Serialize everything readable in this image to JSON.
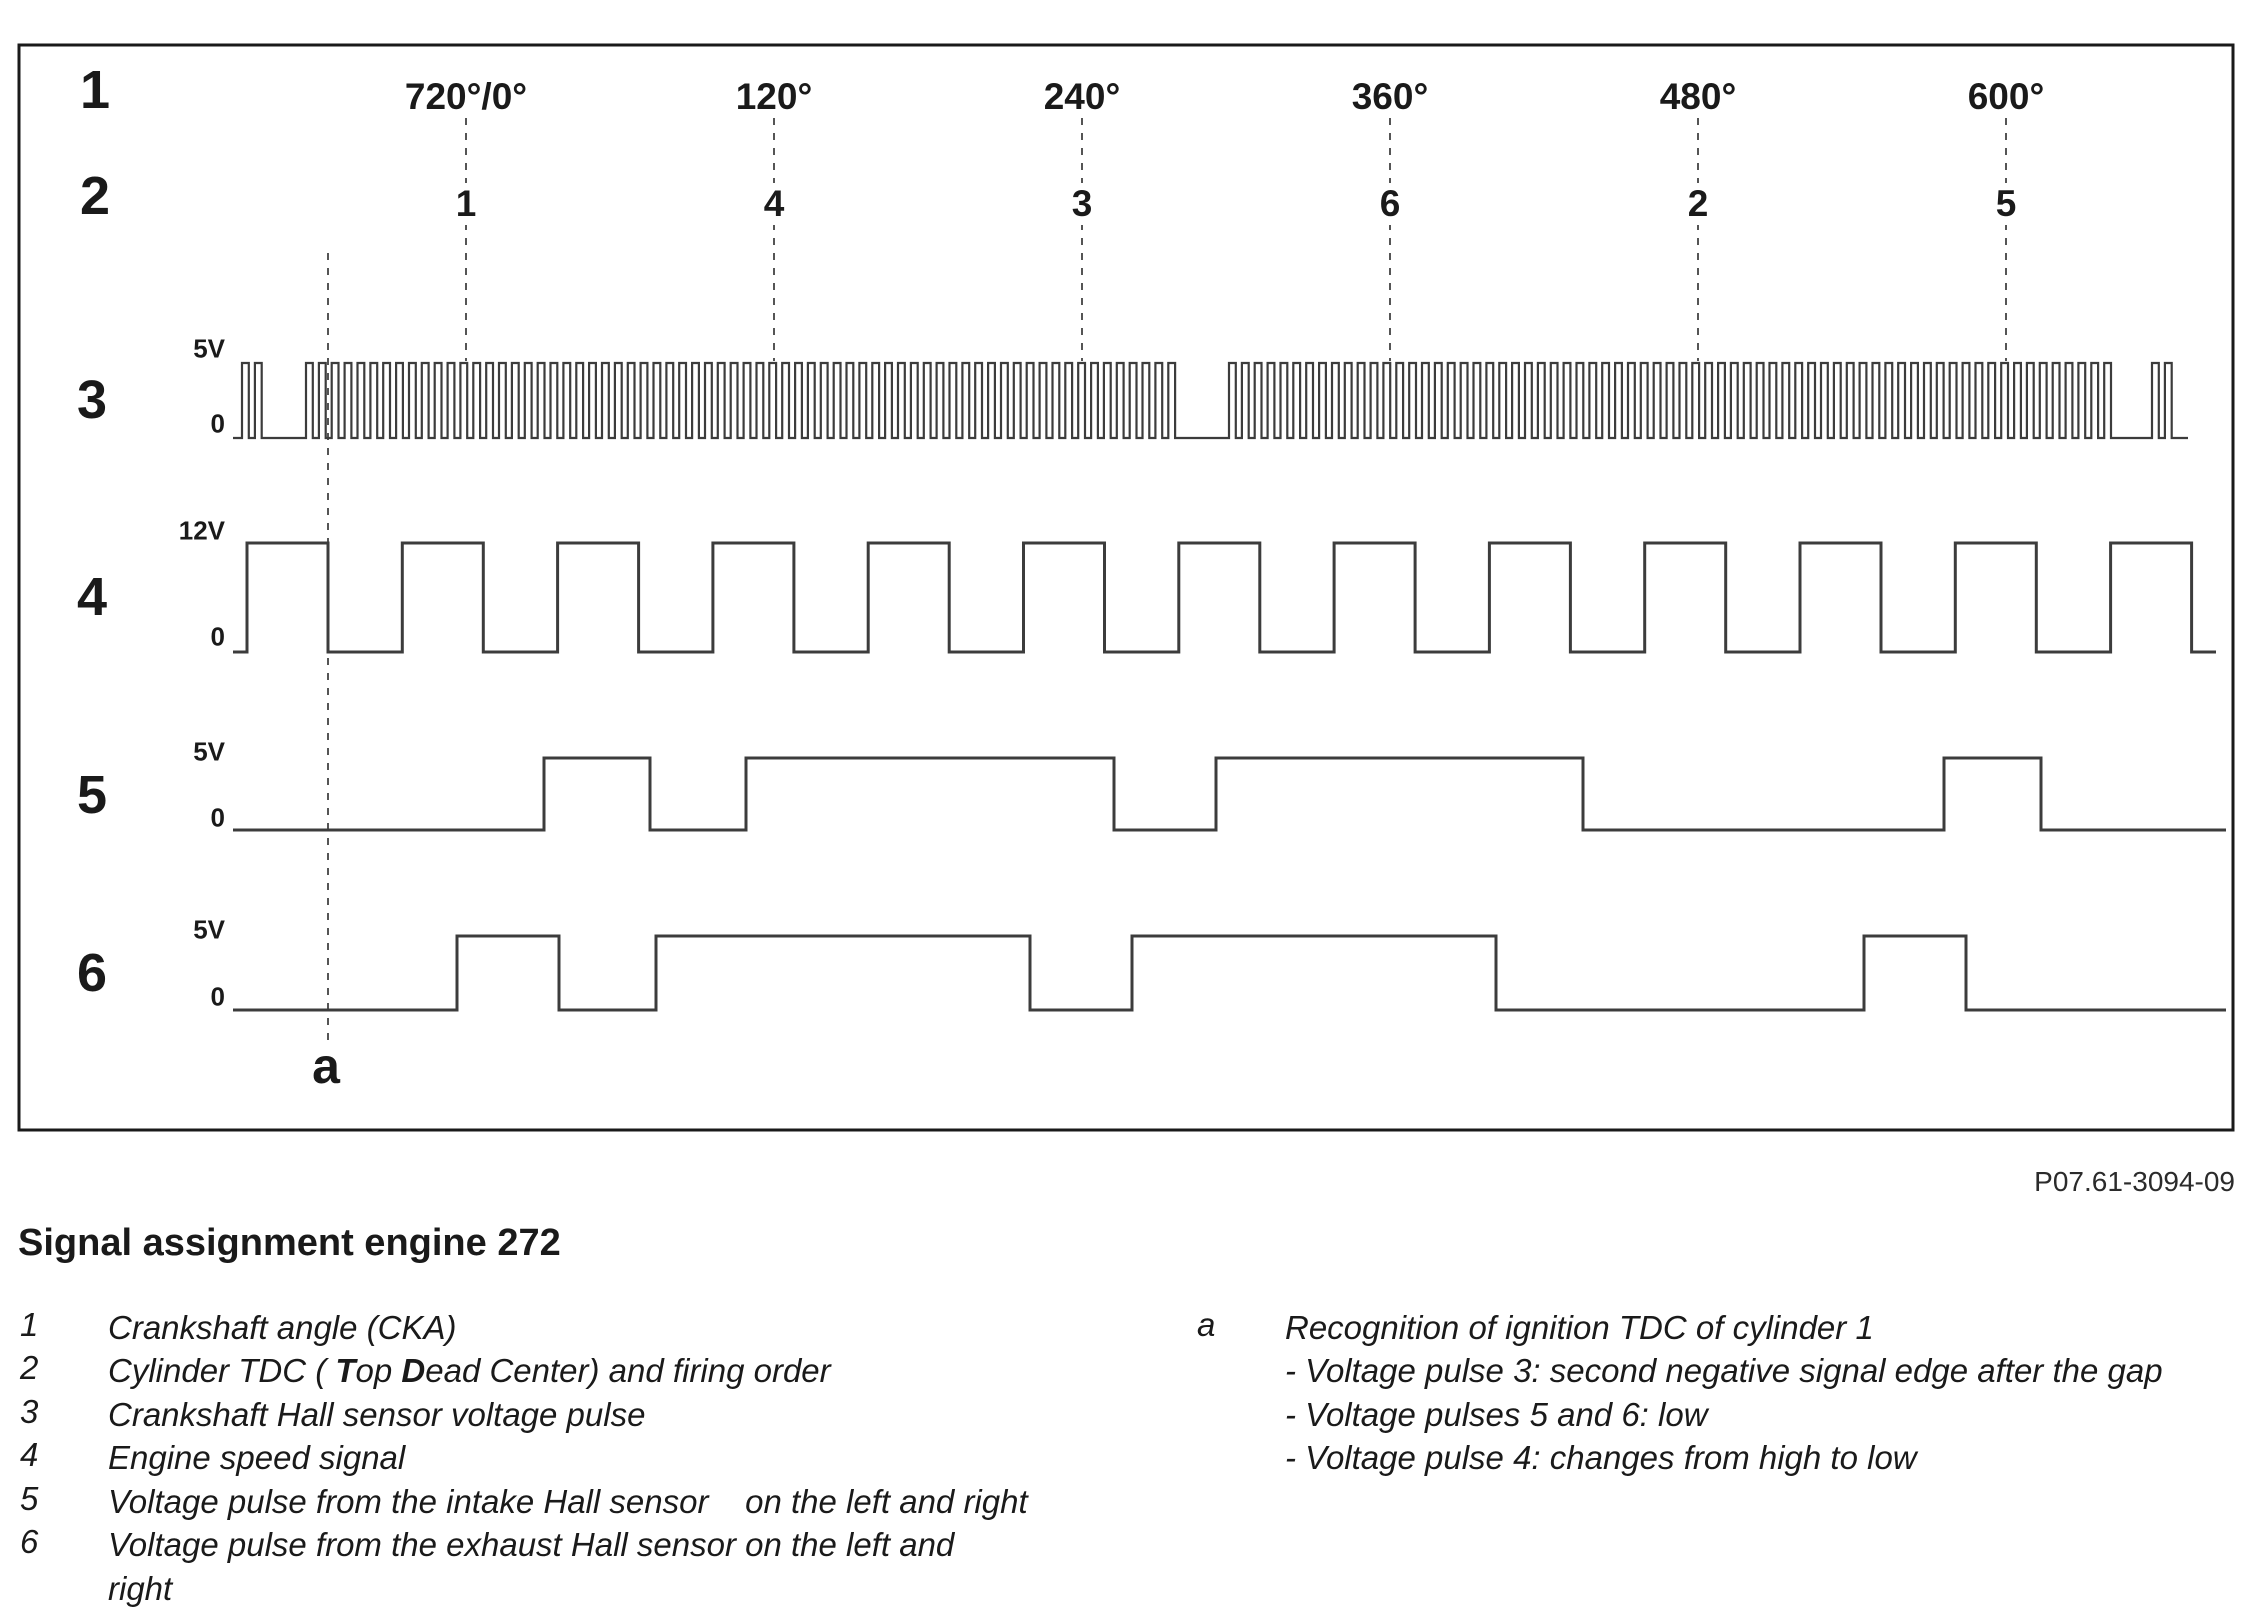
{
  "figure_code": "P07.61-3094-09",
  "title": "Signal assignment engine 272",
  "colors": {
    "background": "#ffffff",
    "text": "#1a1a1a",
    "waveform": "#3c3c3c",
    "dashed_line": "#555555",
    "border": "#1a1a1a"
  },
  "diagram": {
    "row_labels": [
      "1",
      "2",
      "3",
      "4",
      "5",
      "6"
    ],
    "degree_labels": [
      "720°/0°",
      "120°",
      "240°",
      "360°",
      "480°",
      "600°"
    ],
    "firing_order": [
      "1",
      "4",
      "3",
      "6",
      "2",
      "5"
    ],
    "marker_label": "a",
    "signal_rows": [
      {
        "id": "3",
        "high_label": "5V",
        "low_label": "0"
      },
      {
        "id": "4",
        "high_label": "12V",
        "low_label": "0"
      },
      {
        "id": "5",
        "high_label": "5V",
        "low_label": "0"
      },
      {
        "id": "6",
        "high_label": "5V",
        "low_label": "0"
      }
    ]
  },
  "waveforms": {
    "box": {
      "x": 19,
      "y": 45,
      "w": 2214,
      "h": 1085
    },
    "degree_lines": {
      "x": [
        466,
        774,
        1082,
        1390,
        1698,
        2006
      ],
      "y1": 118,
      "y2": 361
    },
    "marker_line": {
      "x": 328,
      "y1": 253,
      "y2": 1045
    },
    "rows": [
      {
        "name": "crankshaft-hall-waveform",
        "y_high": 363,
        "y_low": 438,
        "x_start": 233,
        "x_end": 2188,
        "stroke": 2.2,
        "pitch": 12.87,
        "high_width": 6.8,
        "pulse_groups": [
          {
            "start": 242,
            "count": 2
          },
          {
            "start": 306,
            "count": 68
          },
          {
            "start": 1229,
            "count": 69
          },
          {
            "start": 2152,
            "count": 2
          }
        ]
      },
      {
        "name": "engine-speed-waveform",
        "y_high": 543,
        "y_low": 652,
        "x_start": 233,
        "x_end": 2216,
        "stroke": 3,
        "periodic": {
          "first_rise": 247,
          "period": 155.3,
          "high_width": 81,
          "count": 13
        }
      },
      {
        "name": "intake-hall-waveform",
        "y_high": 758,
        "y_low": 830,
        "x_start": 233,
        "x_end": 2226,
        "stroke": 3,
        "pairs": [
          [
            544,
            650
          ],
          [
            746,
            1114
          ],
          [
            1216,
            1583
          ],
          [
            1944,
            2041
          ]
        ]
      },
      {
        "name": "exhaust-hall-waveform",
        "y_high": 936,
        "y_low": 1010,
        "x_start": 233,
        "x_end": 2226,
        "stroke": 3,
        "pairs": [
          [
            457,
            559
          ],
          [
            656,
            1030
          ],
          [
            1132,
            1496
          ],
          [
            1864,
            1966
          ]
        ]
      }
    ]
  },
  "legend": {
    "left": [
      {
        "num": "1",
        "text": "Crankshaft angle (CKA)"
      },
      {
        "num": "2",
        "parts": [
          "Cylinder TDC ( ",
          "T",
          "op ",
          "D",
          "ead Center) and firing order"
        ]
      },
      {
        "num": "3",
        "text": "Crankshaft Hall sensor voltage pulse"
      },
      {
        "num": "4",
        "text": "Engine speed signal"
      },
      {
        "num": "5",
        "text": "Voltage pulse from the intake Hall sensor    on the left and right"
      },
      {
        "num": "6",
        "text": "Voltage pulse from the exhaust Hall sensor on the left and\nright"
      }
    ],
    "right": {
      "num": "a",
      "text": "Recognition of ignition TDC of cylinder 1",
      "sub": [
        "- Voltage pulse 3: second negative signal edge after the gap",
        "- Voltage pulses 5 and 6: low",
        "- Voltage pulse 4: changes from high to low"
      ]
    }
  }
}
